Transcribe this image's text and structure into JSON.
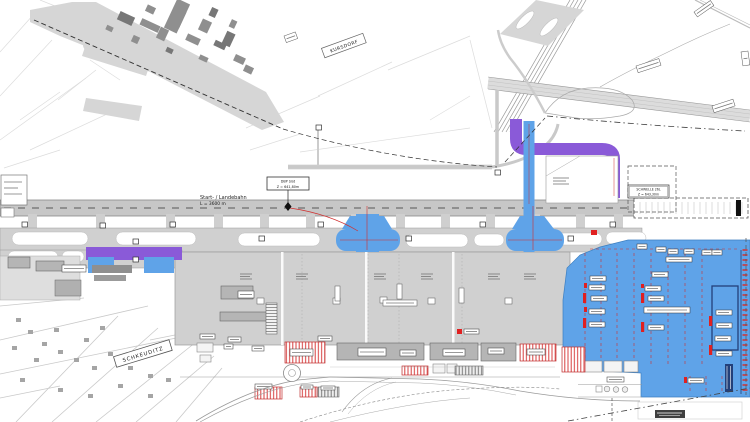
{
  "plan": {
    "runway": {
      "name": "Start- / Landebahn",
      "length": "L = 3600 m"
    },
    "markers": {
      "dbp_line1": "DBP Süd",
      "dbp_line2": "Z = 641,80m",
      "threshold_line1": "SCHWELLE 26L",
      "threshold_line2": "Z = 643,30m"
    },
    "places": {
      "village_north": "KURSDORF",
      "village_south": "SCHKEUDITZ"
    },
    "colors": {
      "apron_blue": "#5fa3e8",
      "taxiway_purple": "#8a5ad8",
      "construction_red": "#e02020",
      "deep_navy": "#23407a",
      "pavement": "#d0d0d0",
      "runway_gray": "#c7c7c7",
      "building_gray": "#8f8f8f"
    }
  }
}
